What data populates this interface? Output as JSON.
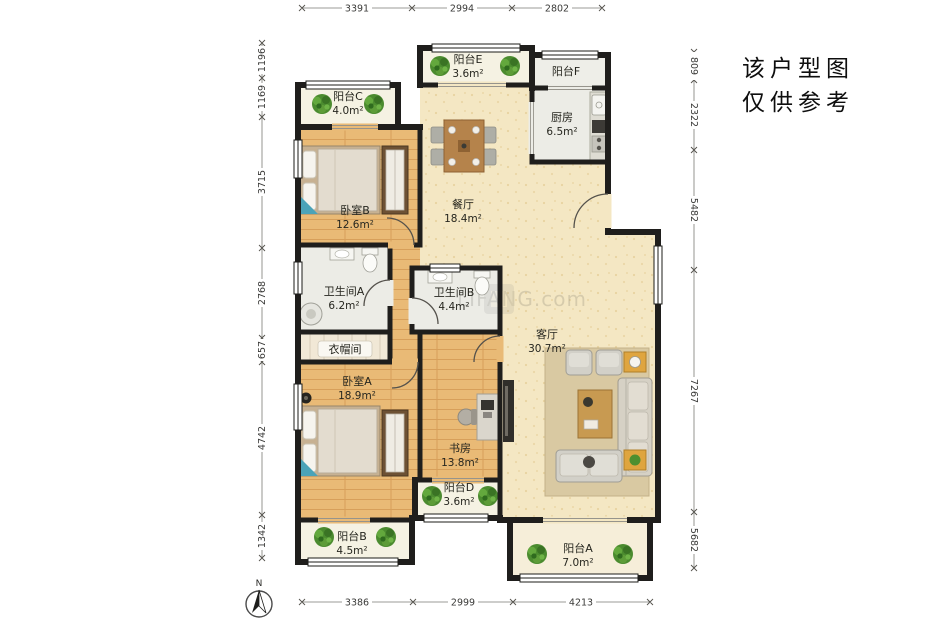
{
  "disclaimer": {
    "line1": "该户型图",
    "line2": "仅供参考"
  },
  "compass": {
    "label": "N"
  },
  "watermark": {
    "text": "LIFANG.com"
  },
  "dimensions": {
    "top": [
      "3391",
      "2994",
      "2802"
    ],
    "bottom": [
      "3386",
      "2999",
      "4213"
    ],
    "left": [
      "1196",
      "1169",
      "3715",
      "2768",
      "657",
      "4742",
      "1342"
    ],
    "right": [
      "809",
      "2322",
      "5482",
      "7267",
      "5682"
    ]
  },
  "rooms": {
    "balcony_c": {
      "name": "阳台C",
      "area": "4.0m²"
    },
    "balcony_e": {
      "name": "阳台E",
      "area": "3.6m²"
    },
    "balcony_f": {
      "name": "阳台F"
    },
    "kitchen": {
      "name": "厨房",
      "area": "6.5m²"
    },
    "bedroom_b": {
      "name": "卧室B",
      "area": "12.6m²"
    },
    "dining": {
      "name": "餐厅",
      "area": "18.4m²"
    },
    "bath_a": {
      "name": "卫生间A",
      "area": "6.2m²"
    },
    "bath_b": {
      "name": "卫生间B",
      "area": "4.4m²"
    },
    "cloakroom": {
      "name": "衣帽间"
    },
    "bedroom_a": {
      "name": "卧室A",
      "area": "18.9m²"
    },
    "study": {
      "name": "书房",
      "area": "13.8m²"
    },
    "living": {
      "name": "客厅",
      "area": "30.7m²"
    },
    "balcony_d": {
      "name": "阳台D",
      "area": "3.6m²"
    },
    "balcony_b": {
      "name": "阳台B",
      "area": "4.5m²"
    },
    "balcony_a": {
      "name": "阳台A",
      "area": "7.0m²"
    }
  },
  "colors": {
    "wall": "#1f1e1c",
    "wood_floor": "#e9ba76",
    "cream_floor": "#f4e7c3",
    "tile_floor": "#ecece6",
    "plant_green": "#4b8b2f"
  }
}
